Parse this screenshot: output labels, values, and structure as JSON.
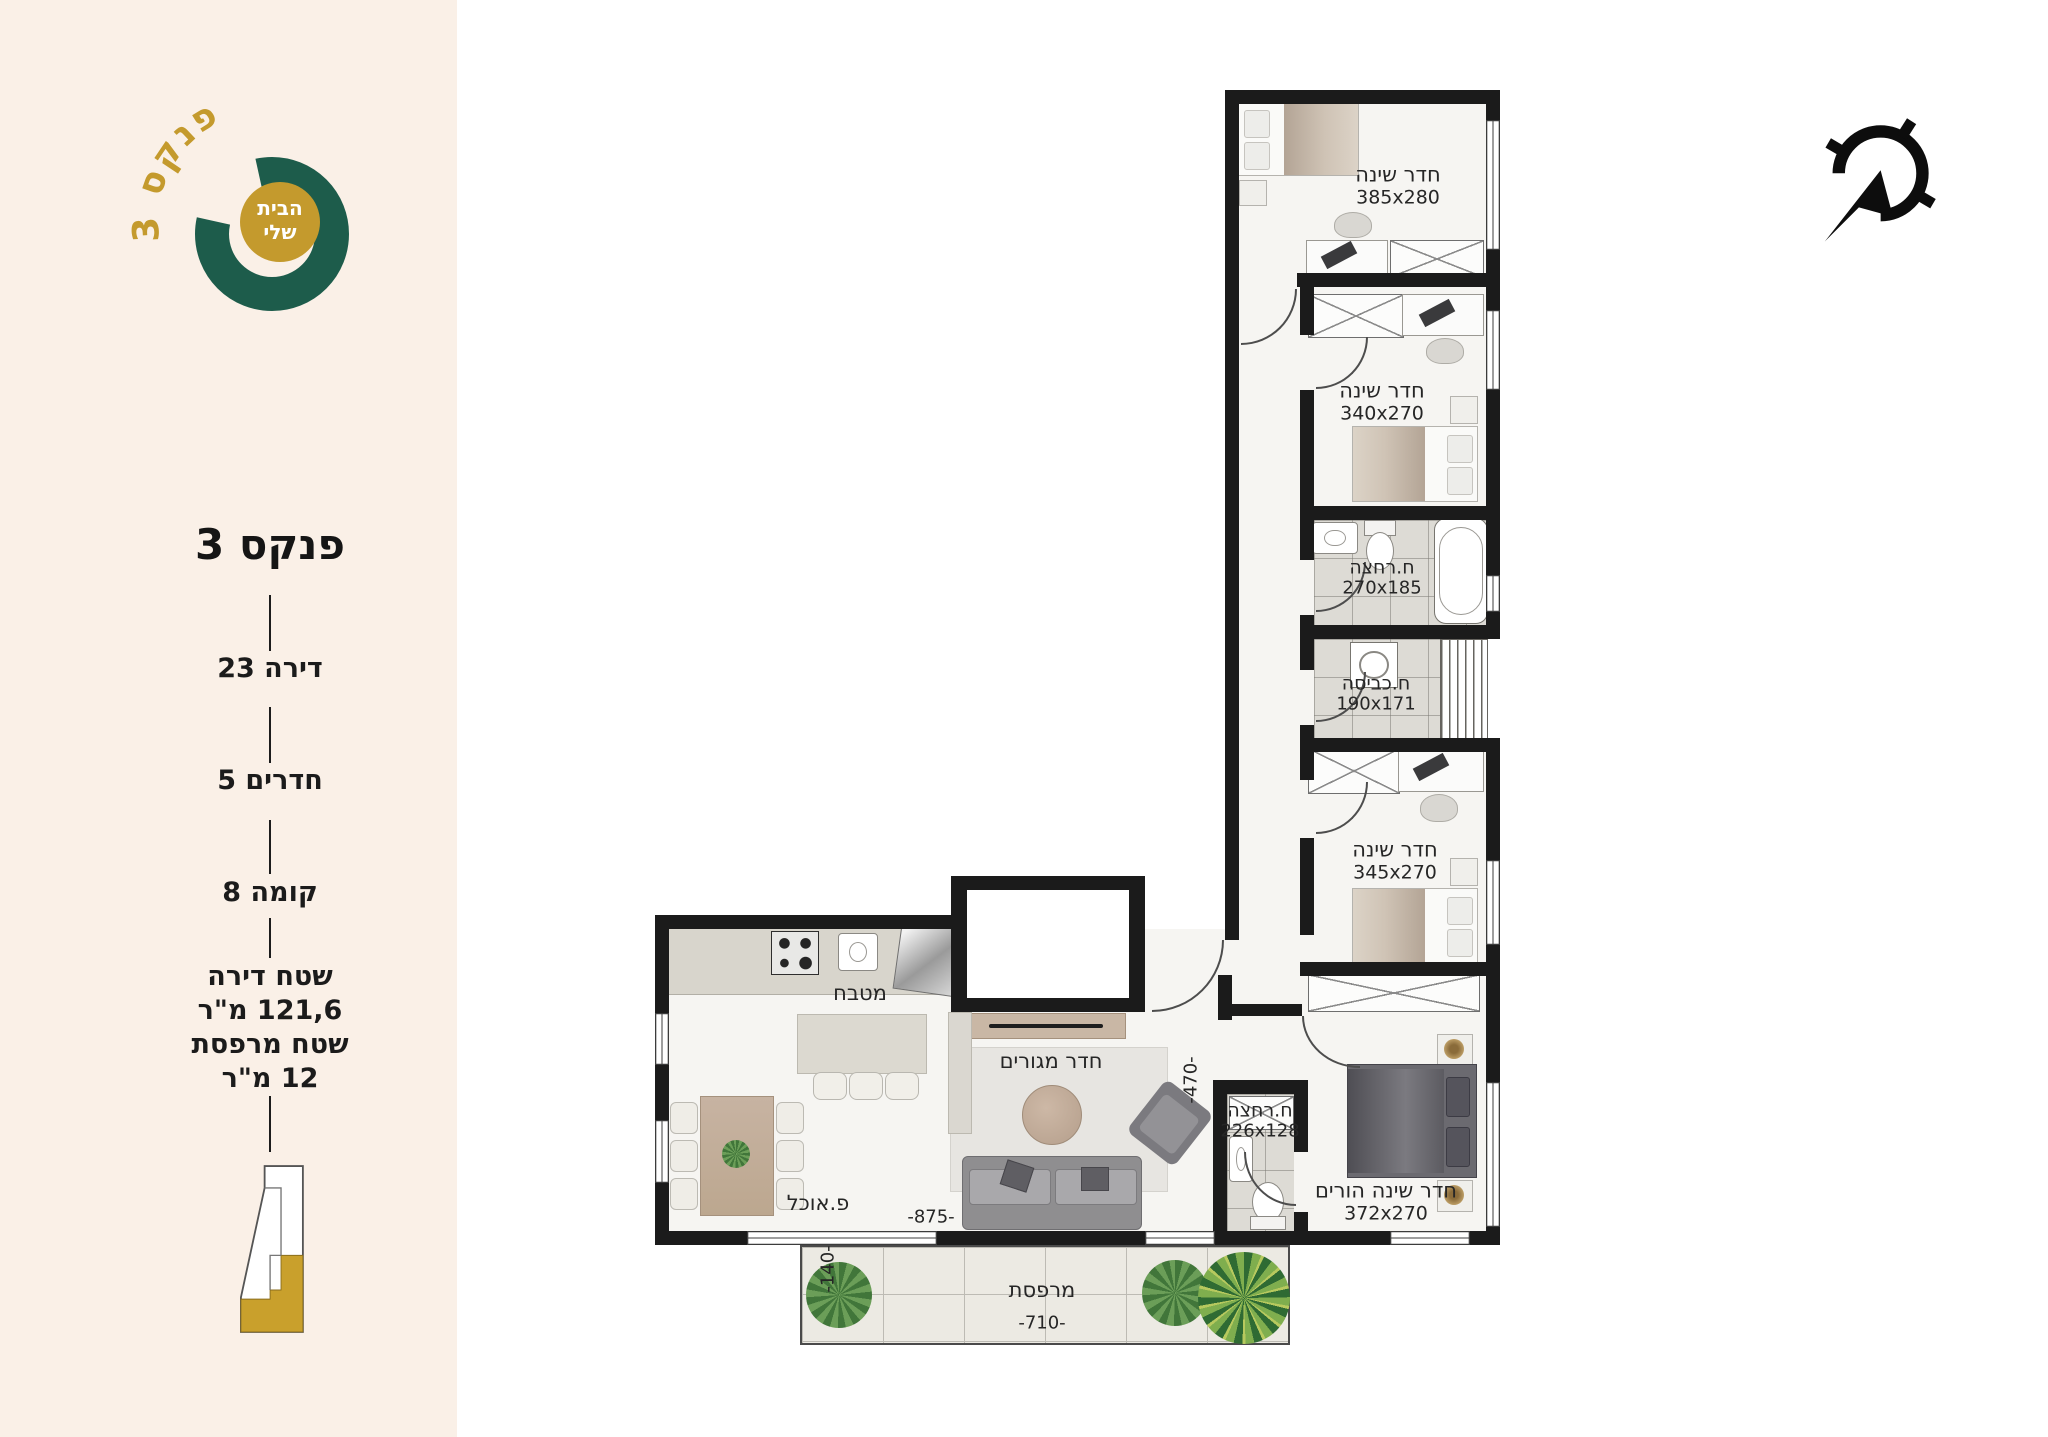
{
  "brand": {
    "arc_text": "פנקס 3",
    "badge_line1": "הבית",
    "badge_line2": "שלי"
  },
  "sidebar": {
    "title": "פנקס 3",
    "items": [
      {
        "label": "דירה 23"
      },
      {
        "label": "חדרים 5"
      },
      {
        "label": "קומה 8"
      }
    ],
    "area": {
      "line1": "שטח דירה",
      "line2": "121,6 מ\"ר"
    },
    "balcony": {
      "line1": "שטח מרפסת",
      "line2": "12 מ\"ר"
    }
  },
  "floorplan": {
    "rooms": [
      {
        "name": "חדר שינה",
        "dims": "385x280"
      },
      {
        "name": "חדר שינה",
        "dims": "340x270"
      },
      {
        "name": "ח.רחצה",
        "dims": "270x185"
      },
      {
        "name": "ח.כביסה",
        "dims": "190x171"
      },
      {
        "name": "חדר שינה",
        "dims": "345x270"
      },
      {
        "name": "מטבח",
        "dims": ""
      },
      {
        "name": "חדר מגורים",
        "dims": ""
      },
      {
        "name": "פ.אוכל",
        "dims": ""
      },
      {
        "name": "ח.רחצה",
        "dims": "226x128"
      },
      {
        "name": "חדר שינה הורים",
        "dims": "372x270"
      },
      {
        "name": "מרפסת",
        "dims": ""
      }
    ],
    "dims": {
      "dining_width": "-875-",
      "living_depth": "-470-",
      "balcony_depth": "-140-",
      "balcony_width": "-710-"
    }
  },
  "icons": {
    "north_arrow": "compass-north-arrow",
    "keyplan": "building-location-outline",
    "logo": "brand-ring-logo"
  },
  "colors": {
    "sidebar_bg": "#faf0e7",
    "brand_green": "#1d5c4b",
    "brand_gold": "#c49a2d",
    "wall": "#1b1b1b",
    "floor": "#f6f5f2"
  }
}
